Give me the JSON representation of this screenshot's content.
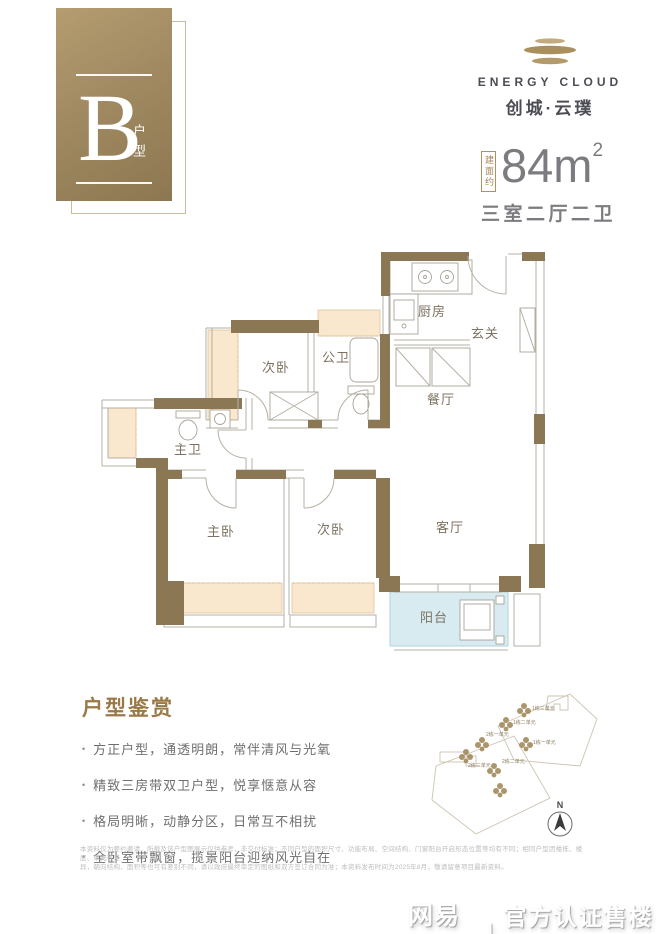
{
  "badge": {
    "letter": "B",
    "label": "户型"
  },
  "logo": {
    "en": "ENERGY CLOUD",
    "cn": "创城·云璞"
  },
  "area": {
    "tag": "建面约",
    "value": "84",
    "unit": "m",
    "sup": "2",
    "layout": "三室二厅二卫"
  },
  "floorplan": {
    "rooms": [
      "厨房",
      "玄关",
      "餐厅",
      "公卫",
      "次卧",
      "主卫",
      "主卧",
      "次卧",
      "客厅",
      "阳台"
    ]
  },
  "features": {
    "title": "户型鉴赏",
    "bullet": "•",
    "items": [
      "方正户型，通透明朗，常伴清风与光氧",
      "精致三房带双卫户型，悦享惬意从容",
      "格局明晰，动静分区，日常互不相扰",
      "全卧室带飘窗，揽景阳台迎纳风光自在"
    ]
  },
  "siteplan": {
    "compass": "N",
    "labels": [
      "1栋三单元",
      "1栋二单元",
      "1栋一单元",
      "2栋一单元",
      "2栋二单元",
      "2栋三单元"
    ]
  },
  "disclaimer": {
    "line1": "本资料仅为要约邀请，所载及该户型图展示仅供参考，非交付标准；不同户型的面积尺寸、功能布局、空间结构、门窗阳台开启形态位置等均有不同；相同户型因楼栋、楼层、单元等差",
    "line2": "异，朝向结构、面积等也可有差别不同，请以政府最终审定的图纸和双方签订合同为准；本资料发布时间为2025年8月，敬请留意项目最新资料。"
  },
  "watermark": {
    "brand": "网易号",
    "divider": "|",
    "label": "官方认证售楼处"
  }
}
